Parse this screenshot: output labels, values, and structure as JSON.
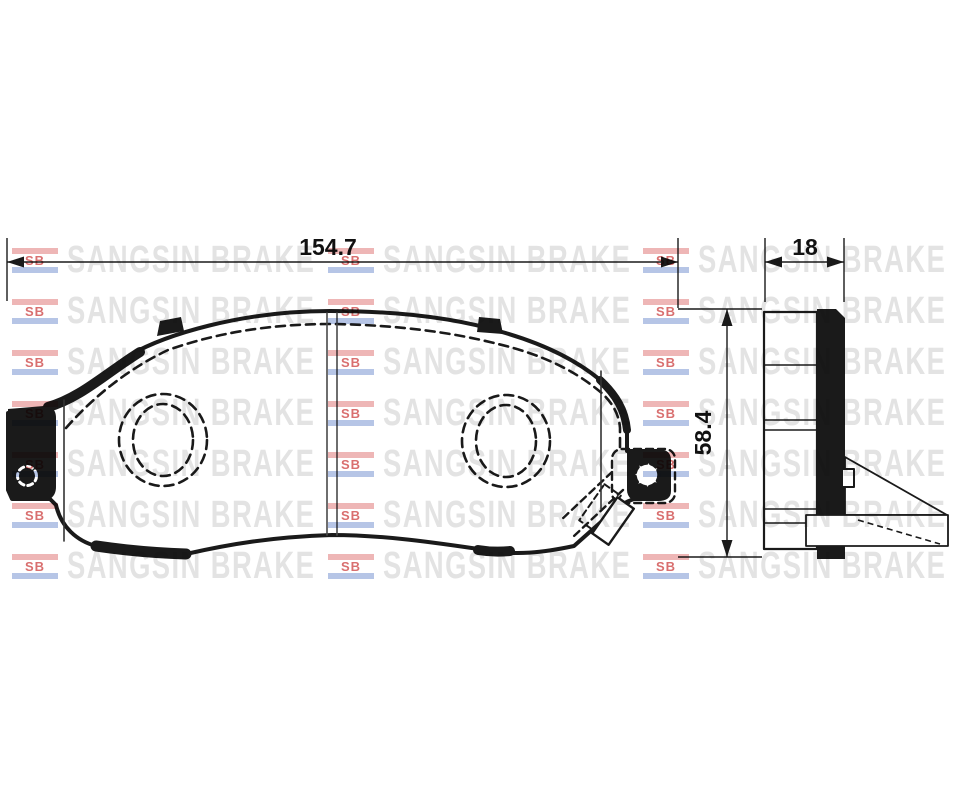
{
  "dimensions": {
    "width": "154.7",
    "thickness": "18",
    "height": "58.4"
  },
  "watermark": {
    "brand": "SANGSIN BRAKE",
    "logo": "SB",
    "grid": {
      "rows": 7,
      "cols": 3,
      "col_x": [
        12,
        328,
        643
      ],
      "first_row_center_y": 260,
      "row_pitch": 51
    },
    "colors": {
      "text": "#e3e3e3",
      "logo_text": "#d96f6f",
      "bar_red": "#eeb6b6",
      "bar_blue": "#b6c5e6"
    }
  },
  "canvas": {
    "ink": "#1a1a1a",
    "background": "#ffffff"
  }
}
